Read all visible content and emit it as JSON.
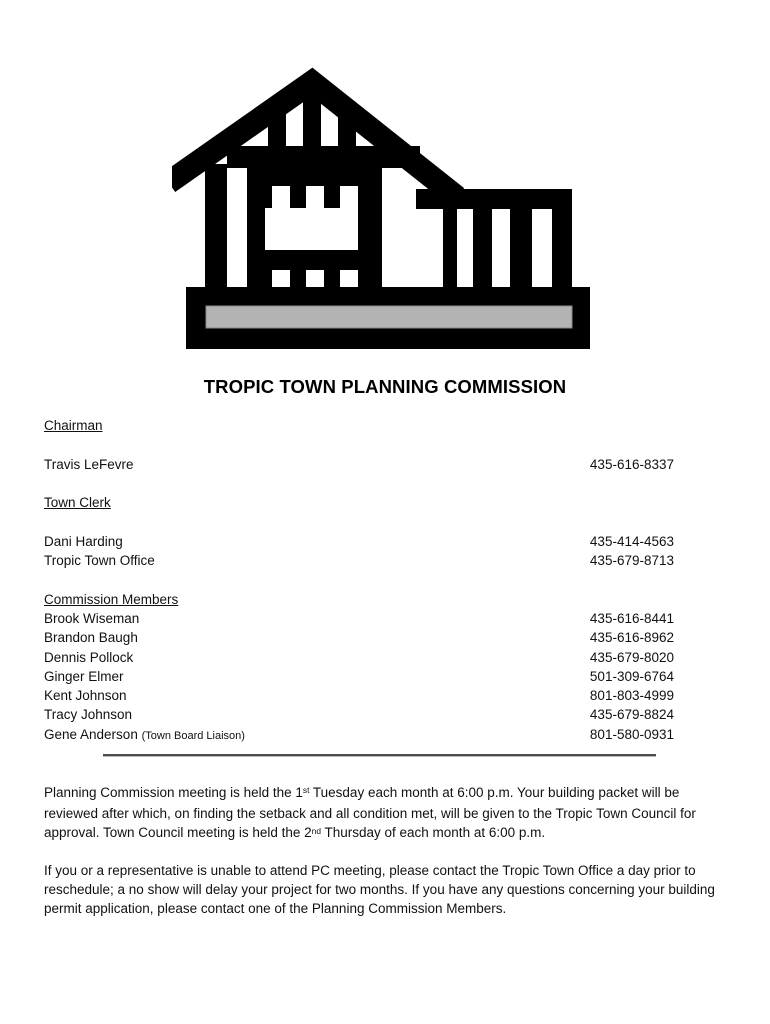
{
  "page": {
    "title": "TROPIC TOWN PLANNING COMMISSION"
  },
  "icon": {
    "label": "building-under-construction",
    "fill": "#000000",
    "slab_color": "#b3b3b3"
  },
  "sections": [
    {
      "heading": "Chairman",
      "entries": [
        {
          "name": "Travis LeFevre",
          "phone": "435-616-8337"
        }
      ]
    },
    {
      "heading": "Town Clerk",
      "entries": [
        {
          "name": "Dani Harding",
          "phone": "435-414-4563"
        },
        {
          "name": "Tropic Town Office",
          "phone": "435-679-8713"
        }
      ]
    },
    {
      "heading": "Commission Members",
      "entries": [
        {
          "name": "Brook Wiseman",
          "phone": "435-616-8441"
        },
        {
          "name": "Brandon Baugh",
          "phone": "435-616-8962"
        },
        {
          "name": "Dennis Pollock",
          "phone": "435-679-8020"
        },
        {
          "name": "Ginger Elmer",
          "phone": "501-309-6764"
        },
        {
          "name": "Kent Johnson",
          "phone": "801-803-4999"
        },
        {
          "name": "Tracy Johnson",
          "phone": "435-679-8824"
        },
        {
          "name": "Gene Anderson",
          "note": "(Town Board Liaison)",
          "phone": "801-580-0931"
        }
      ]
    }
  ],
  "paragraphs": {
    "p1": {
      "part1": "Planning Commission meeting is held the 1",
      "sup1": "st",
      "part2": " Tuesday each month at 6:00 p.m. Your building packet will be reviewed after which, on finding the setback and all condition met, will be given to the Tropic Town Council for approval. Town Council meeting is held the 2",
      "sup2": "nd",
      "part3": " Thursday of each month at 6:00 p.m."
    },
    "p2": "If you or a representative is unable to attend PC meeting, please contact the Tropic Town Office a day prior to reschedule; a no show will delay your project for two months. If you have any questions concerning your building permit application, please contact one of the Planning Commission Members."
  }
}
